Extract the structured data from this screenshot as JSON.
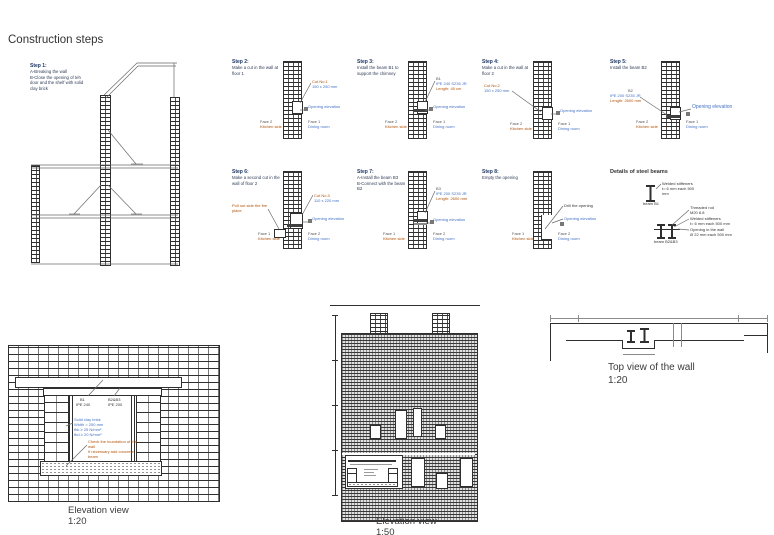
{
  "title": "Construction steps",
  "s1": {
    "t": "Step 1:",
    "d": "A-Breaking the wall\nB-Close the opening of teh\ndoor and the shelf with solid\nclay brick"
  },
  "s2": {
    "t": "Step 2:",
    "d": "Make a cut in the wall at\nfloor 1",
    "cut_name": "Cut No.1",
    "cut_dim": "150 x 250 mm",
    "open": "Opening elevation",
    "fl1": "Face 2",
    "fl2": "Kitchen side",
    "fr1": "Face 1",
    "fr2": "Dining room"
  },
  "s3": {
    "t": "Step 3:",
    "d": "Install the beam B1 to\nsupport the chimney",
    "bm1": "B1",
    "bm2": "IPE 240 S235 JR",
    "bm3": "Length: 45 cm",
    "open": "Opening elevation",
    "fl1": "Face 2",
    "fl2": "Kitchen side",
    "fr1": "Face 1",
    "fr2": "Dining room"
  },
  "s4": {
    "t": "Step 4:",
    "d": "Make a cut in the wall at\nfloor 2",
    "cut_name": "Cut No.2",
    "cut_dim": "150 x 250 mm",
    "open": "Opening elevation",
    "fl1": "Face 2",
    "fl2": "Kitchen side",
    "fr1": "Face 1",
    "fr2": "Dining room"
  },
  "s5": {
    "t": "Step 5:",
    "d": "Install the beam B2",
    "bm1": "B2",
    "bm2": "IPE 200 S235 JR",
    "bm3": "Length: 2600 mm",
    "open": "Opening elevation",
    "fl1": "Face 2",
    "fl2": "Kitchen side",
    "fr1": "Face 1",
    "fr2": "Dining room"
  },
  "s6": {
    "t": "Step 6:",
    "d": "Make a second cut in the\nwall of floor 2",
    "pull": "Pull out side the fire\nplace",
    "cut_name": "Cut No.3",
    "cut_dim": "110 x 220 mm",
    "open": "Opening elevation",
    "fl1": "Face 1",
    "fl2": "Kitchen side",
    "fr1": "Face 2",
    "fr2": "Dining room"
  },
  "s7": {
    "t": "Step 7:",
    "d": "A-Install the beam B3\nB-Connect with the beam\nB2",
    "bm1": "B3",
    "bm2": "IPE 200 S235 JR",
    "bm3": "Length: 2600 mm",
    "open": "Opening elevation",
    "fl1": "Face 1",
    "fl2": "Kitchen side",
    "fr1": "Face 2",
    "fr2": "Dining room"
  },
  "s8": {
    "t": "Step 8:",
    "d": "Empty the opening",
    "drill": "Drill the opening",
    "open": "Opening elevation",
    "fl1": "Face 1",
    "fl2": "Kitchen side",
    "fr1": "Face 2",
    "fr2": "Dining room"
  },
  "det": {
    "t": "Details of steel beams",
    "n1": "Welded stiffeners\nt= 6 mm each 500\nmm",
    "l1": "beam B1",
    "rod": "Threaded rod\nM20 8.8",
    "stiff": "Welded stiffeners\nt= 6 mm each 500 mm",
    "hole": "Opening in the wall\nØ 22 mm each 500 mm",
    "l2": "beam B2&B3"
  },
  "ev20": {
    "b1a": "B1",
    "b1b": "IPE 240",
    "b2a": "B2&B3",
    "b2b": "IPE 200",
    "brick": "Solid clay brick\nWidth = 250 mm\nfbk ≥ 25 N/mm²\nfbd ≥ 20 N/mm²",
    "found": "Check the foundation of the\nwall\nIf necessary add concrete\nbeam",
    "cap": "Elevation view",
    "scale": "1:20"
  },
  "ev50": {
    "cap": "Elevation view",
    "scale": "1:50"
  },
  "top": {
    "cap": "Top view of the wall",
    "scale": "1:20"
  }
}
